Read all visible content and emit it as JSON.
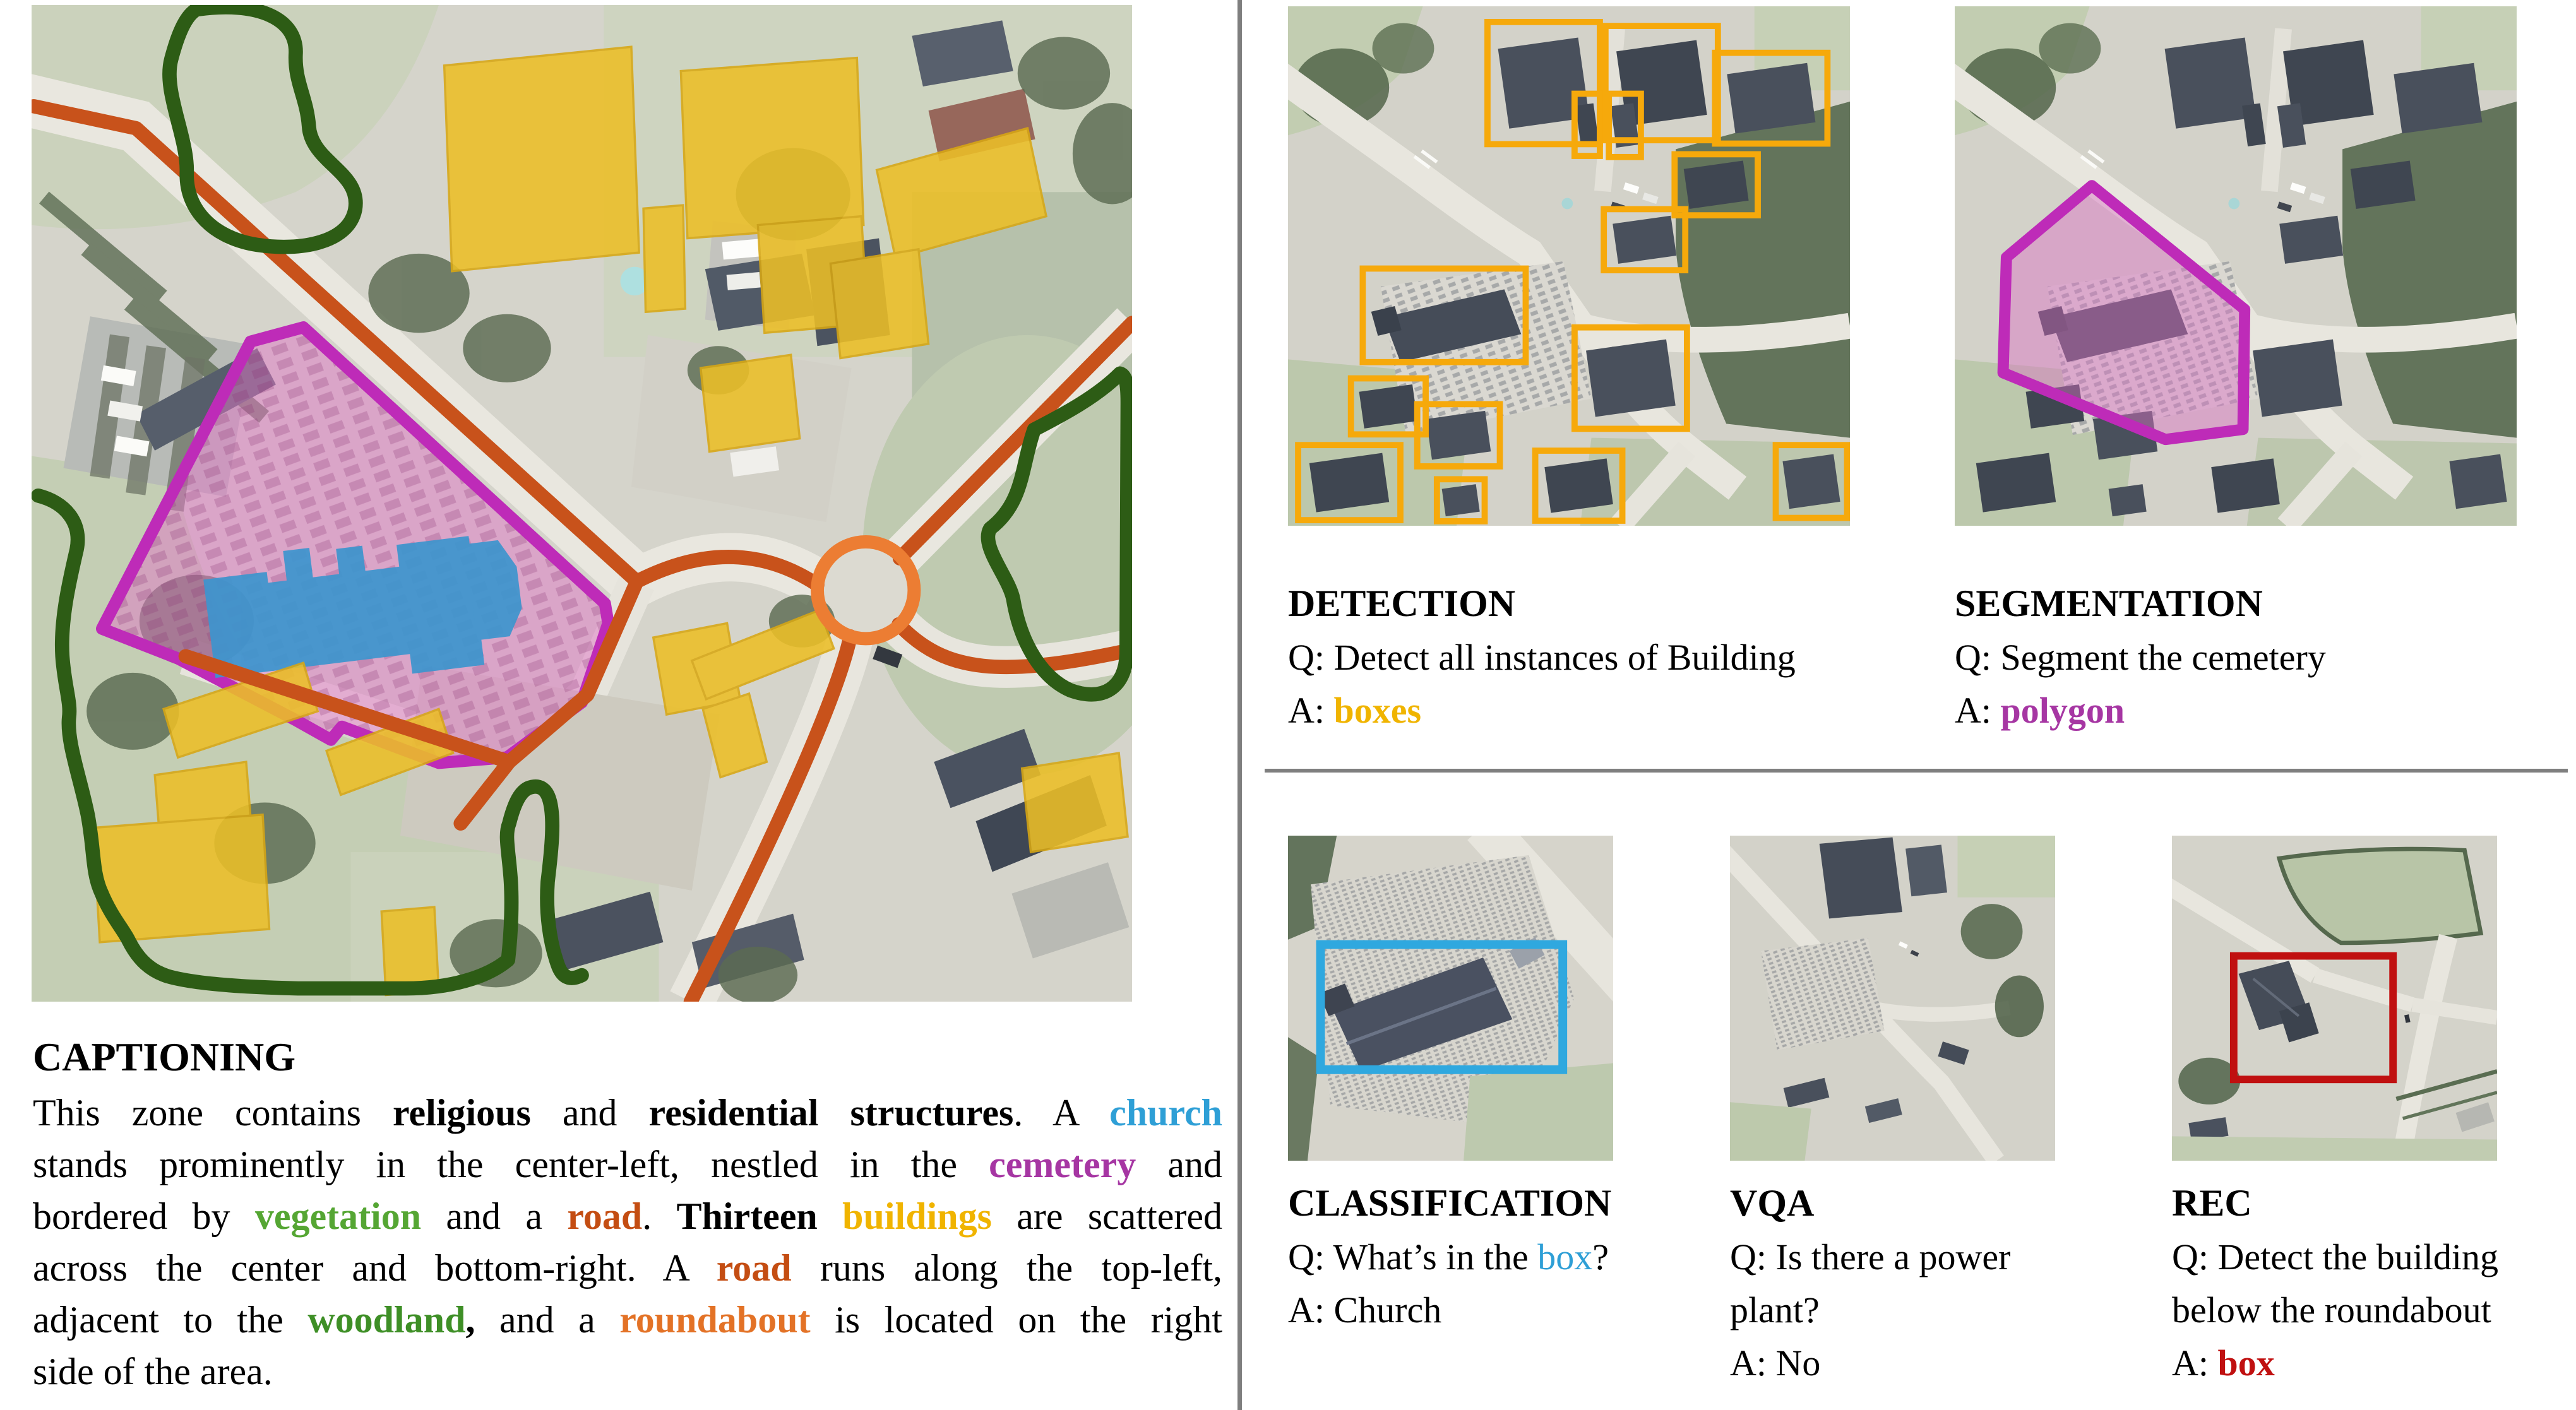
{
  "colors": {
    "church_blue": "#2E9FD6",
    "cemetery_purple": "#A636A3",
    "vegetation_green": "#55A633",
    "woodland_green": "#3E8F26",
    "road_rust": "#C44D12",
    "buildings_gold": "#F0B400",
    "roundabout_orange": "#E37226",
    "rec_red": "#C01010",
    "divider_gray": "#7F7F7F",
    "detection_box_stroke": "#F6A90B",
    "segmentation_stroke": "#BE2BB8",
    "classification_box_stroke": "#2FA8DF",
    "map_road_stroke": "#C8521B",
    "map_roundabout_stroke": "#EC7D33",
    "map_woodland_stroke": "#2D5C15",
    "map_cemetery_fill": "rgba(223,118,198,0.5)",
    "map_church_fill": "#3D95CE",
    "map_building_fill": "#ECBF27"
  },
  "captioning": {
    "title": "CAPTIONING",
    "lines": [
      [
        {
          "t": "This zone contains "
        },
        {
          "t": "religious",
          "b": true
        },
        {
          "t": " and "
        },
        {
          "t": "residential structures",
          "b": true
        },
        {
          "t": ". A "
        },
        {
          "t": "church",
          "color": "church_blue",
          "b": true
        }
      ],
      [
        {
          "t": "stands prominently in the center-left, nestled in the "
        },
        {
          "t": "cemetery",
          "color": "cemetery_purple",
          "b": true
        },
        {
          "t": " and"
        }
      ],
      [
        {
          "t": "bordered by "
        },
        {
          "t": "vegetation",
          "color": "vegetation_green",
          "b": true
        },
        {
          "t": " and a "
        },
        {
          "t": "road",
          "color": "road_rust",
          "b": true
        },
        {
          "t": ". "
        },
        {
          "t": "Thirteen",
          "b": true
        },
        {
          "t": " "
        },
        {
          "t": "buildings",
          "color": "buildings_gold",
          "b": true
        },
        {
          "t": " are scattered"
        }
      ],
      [
        {
          "t": "across the center and bottom-right. A "
        },
        {
          "t": "road",
          "color": "road_rust",
          "b": true
        },
        {
          "t": " runs along the top-left,"
        }
      ],
      [
        {
          "t": "adjacent to the "
        },
        {
          "t": "woodland",
          "color": "woodland_green",
          "b": true
        },
        {
          "t": ",",
          "b": true
        },
        {
          "t": " and a "
        },
        {
          "t": "roundabout",
          "color": "roundabout_orange",
          "b": true
        },
        {
          "t": " is located on the right"
        }
      ],
      [
        {
          "t": "side of the area."
        }
      ]
    ]
  },
  "tasks": {
    "detection": {
      "title": "DETECTION",
      "q_lines": [
        [
          {
            "t": "Q: Detect all instances of Building"
          }
        ]
      ],
      "a_lines": [
        [
          {
            "t": "A: "
          },
          {
            "t": "boxes",
            "color": "buildings_gold",
            "b": true
          }
        ]
      ],
      "boxes": [
        [
          355,
          28,
          200,
          218
        ],
        [
          565,
          35,
          200,
          204
        ],
        [
          760,
          83,
          200,
          162
        ],
        [
          510,
          156,
          45,
          111
        ],
        [
          571,
          156,
          57,
          113
        ],
        [
          688,
          264,
          148,
          109
        ],
        [
          562,
          362,
          145,
          109
        ],
        [
          133,
          468,
          290,
          167
        ],
        [
          510,
          573,
          200,
          181
        ],
        [
          112,
          664,
          133,
          100
        ],
        [
          230,
          710,
          147,
          111
        ],
        [
          18,
          783,
          182,
          134
        ],
        [
          265,
          844,
          85,
          75
        ],
        [
          440,
          793,
          155,
          125
        ],
        [
          868,
          783,
          127,
          130
        ]
      ]
    },
    "segmentation": {
      "title": "SEGMENTATION",
      "q_lines": [
        [
          {
            "t": "Q: Segment the cemetery"
          }
        ]
      ],
      "a_lines": [
        [
          {
            "t": "A: "
          },
          {
            "t": "polygon",
            "color": "cemetery_purple",
            "b": true
          }
        ]
      ],
      "polygon": [
        [
          244,
          320
        ],
        [
          516,
          541
        ],
        [
          513,
          755
        ],
        [
          375,
          773
        ],
        [
          86,
          654
        ],
        [
          92,
          448
        ]
      ]
    },
    "classification": {
      "title": "CLASSIFICATION",
      "q_lines": [
        [
          {
            "t": "Q: What’s in the "
          },
          {
            "t": "box",
            "color": "church_blue"
          },
          {
            "t": "?"
          }
        ]
      ],
      "a_lines": [
        [
          {
            "t": "A: Church"
          }
        ]
      ],
      "box": [
        100,
        335,
        745,
        385
      ]
    },
    "vqa": {
      "title": "VQA",
      "q_lines": [
        [
          {
            "t": "Q: Is there a power"
          }
        ],
        [
          {
            "t": "plant?"
          }
        ]
      ],
      "a_lines": [
        [
          {
            "t": "A: No"
          }
        ]
      ]
    },
    "rec": {
      "title": "REC",
      "q_lines": [
        [
          {
            "t": "Q: Detect the building"
          }
        ],
        [
          {
            "t": "below the roundabout"
          }
        ]
      ],
      "a_lines": [
        [
          {
            "t": "A: "
          },
          {
            "t": "box",
            "color": "rec_red",
            "b": true
          }
        ]
      ],
      "box": [
        190,
        370,
        490,
        380
      ]
    }
  }
}
